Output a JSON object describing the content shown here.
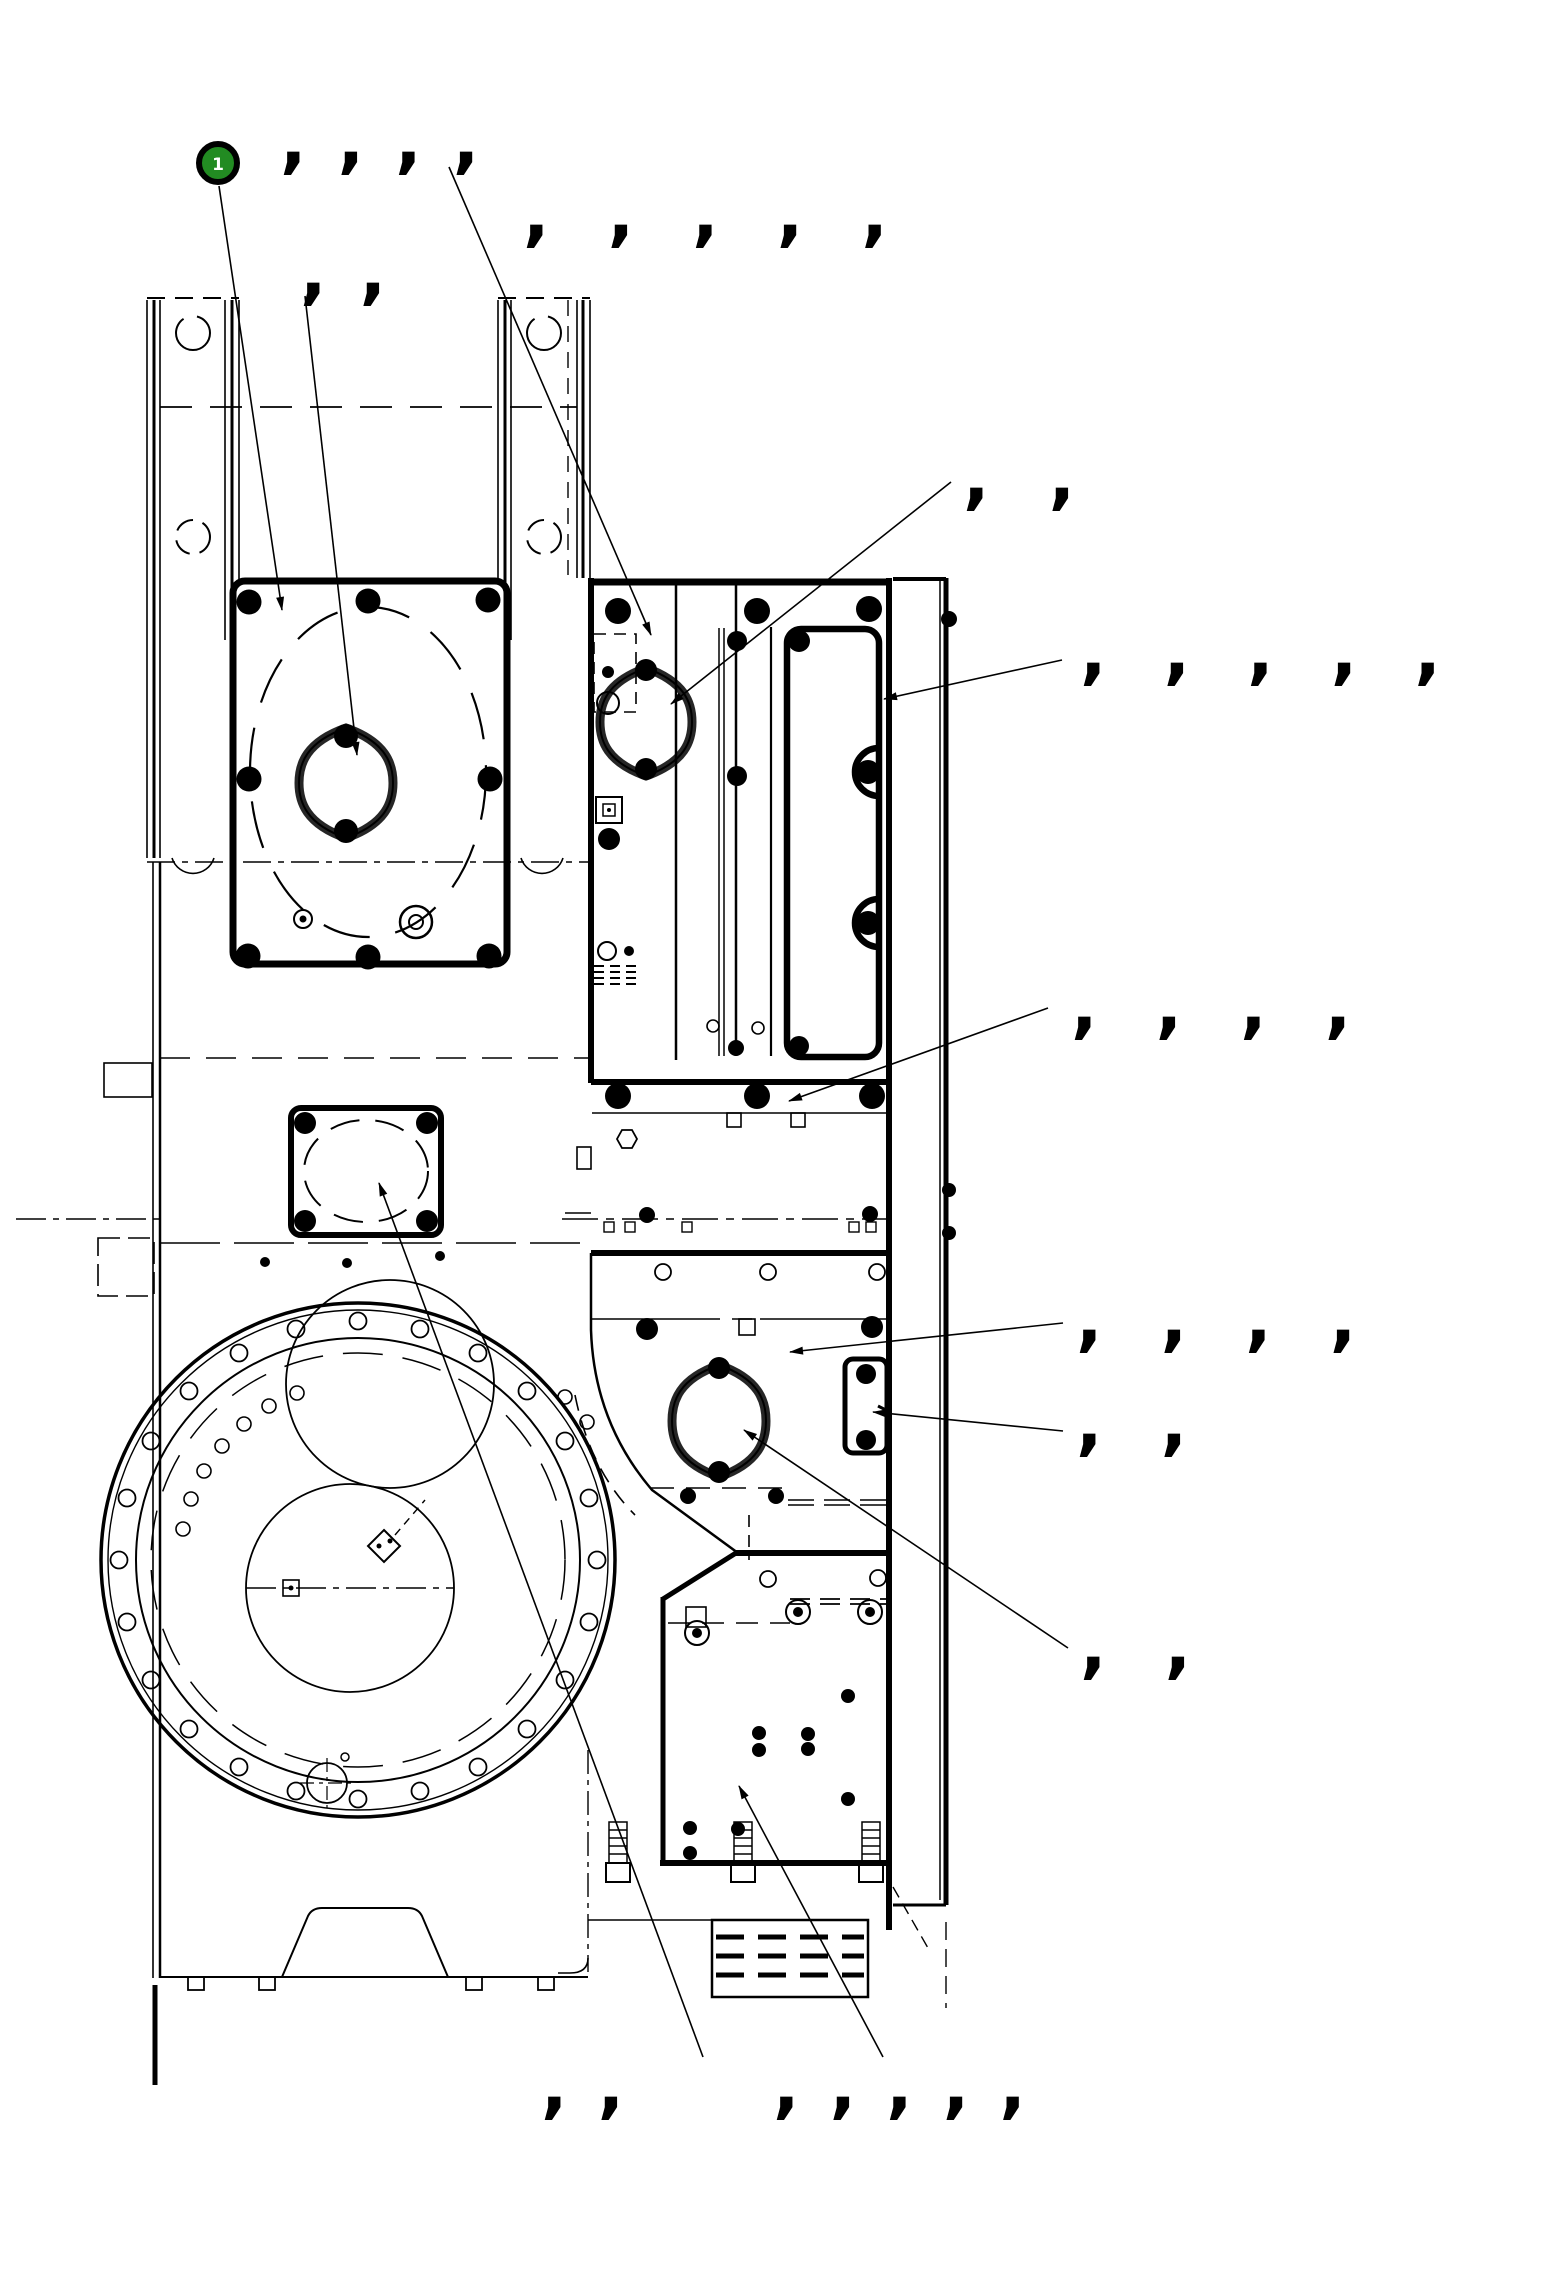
{
  "drawing": {
    "balloon": {
      "number": "1",
      "fill": "#228b22",
      "ring": "#000000",
      "text_color": "#ffffff"
    },
    "colors": {
      "background": "#ffffff",
      "line": "#000000"
    },
    "labels": [
      {
        "id": "g1",
        "text": ",,,,",
        "x": 280,
        "y": 106,
        "ls": 31
      },
      {
        "id": "g2",
        "text": ",,,,,",
        "x": 523,
        "y": 179,
        "ls": 58
      },
      {
        "id": "g3",
        "text": ",,",
        "x": 300,
        "y": 237,
        "ls": 33
      },
      {
        "id": "g4",
        "text": ",,",
        "x": 963,
        "y": 442,
        "ls": 59
      },
      {
        "id": "g5",
        "text": ",,,,,",
        "x": 1080,
        "y": 617,
        "ls": 57
      },
      {
        "id": "g6",
        "text": ",,,,",
        "x": 1071,
        "y": 971,
        "ls": 58
      },
      {
        "id": "g7",
        "text": ",,,,",
        "x": 1076,
        "y": 1284,
        "ls": 58
      },
      {
        "id": "g8",
        "text": ",,",
        "x": 1076,
        "y": 1388,
        "ls": 58
      },
      {
        "id": "g9",
        "text": ",,",
        "x": 1080,
        "y": 1611,
        "ls": 58
      },
      {
        "id": "g10",
        "text": ",,",
        "x": 541,
        "y": 2051,
        "ls": 30
      },
      {
        "id": "g11",
        "text": ",,,,,",
        "x": 773,
        "y": 2051,
        "ls": 30
      }
    ]
  }
}
